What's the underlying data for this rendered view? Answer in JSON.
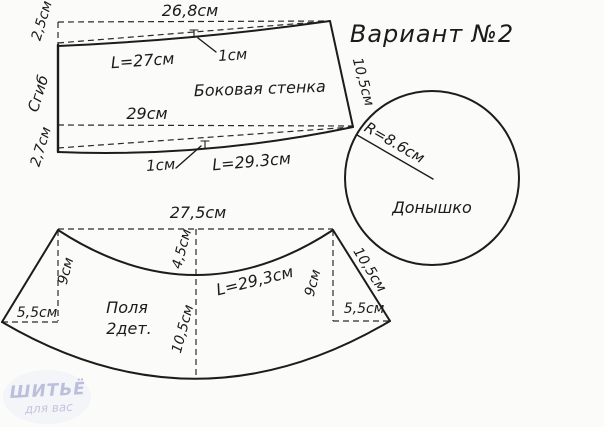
{
  "title": "Вариант №2",
  "side_wall": {
    "name": "Боковая стенка",
    "top_width": "26,8см",
    "top_arc_length": "L=27см",
    "top_notch": "1см",
    "left_top_offset": "2,5см",
    "fold_label": "Сгиб",
    "left_bottom_offset": "2,7см",
    "bottom_width": "29см",
    "bottom_notch": "1см",
    "bottom_arc_length": "L=29.3см",
    "right_edge": "10,5см"
  },
  "crown": {
    "name": "Донышко",
    "radius": "R=8.6см"
  },
  "brim": {
    "name_line1": "Поля",
    "name_line2": "2дет.",
    "top_width": "27,5см",
    "top_curve_drop": "4,5см",
    "center_height": "10,5см",
    "left_height": "9см",
    "right_height": "9см",
    "left_base": "5,5см",
    "right_base": "5,5см",
    "right_edge": "10,5см",
    "bottom_arc_length": "L=29,3см"
  },
  "watermark": {
    "line1": "ШИТЬЁ",
    "line2": "для вас"
  },
  "colors": {
    "line": "#1c1c1c",
    "background": "#fbfbf9",
    "watermark": "#b0b5d6"
  }
}
